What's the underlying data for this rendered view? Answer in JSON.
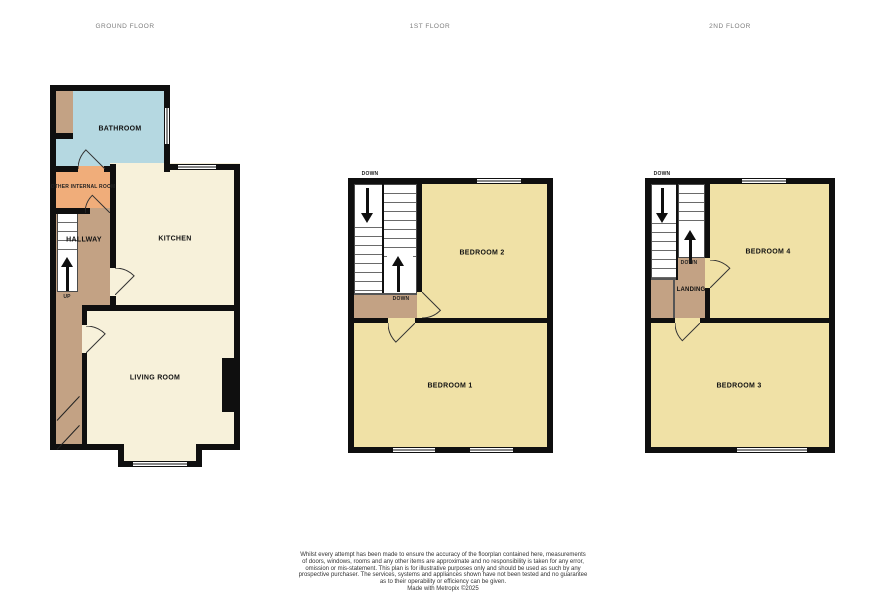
{
  "floors": [
    {
      "title": "GROUND FLOOR",
      "rooms": {
        "bathroom": "BATHROOM",
        "other_internal": "OTHER INTERNAL ROOM",
        "hallway": "HALLWAY",
        "kitchen": "KITCHEN",
        "living_room": "LIVING ROOM"
      },
      "stair_labels": {
        "up": "UP"
      }
    },
    {
      "title": "1ST FLOOR",
      "rooms": {
        "bedroom2": "BEDROOM 2",
        "bedroom1": "BEDROOM 1"
      },
      "stair_labels": {
        "down_exterior": "DOWN",
        "down_landing": "DOWN"
      }
    },
    {
      "title": "2ND FLOOR",
      "rooms": {
        "bedroom4": "BEDROOM 4",
        "bedroom3": "BEDROOM 3",
        "landing": "LANDING"
      },
      "stair_labels": {
        "down_exterior": "DOWN",
        "down_landing": "DOWN"
      }
    }
  ],
  "footer": {
    "disclaimer_lines": [
      "Whilst every attempt has been made to ensure the accuracy of the floorplan contained here, measurements",
      "of doors, windows, rooms and any other items are approximate and no responsibility is taken for any error,",
      "omission or mis-statement. This plan is for illustrative purposes only and should be used as such by any",
      "prospective purchaser. The services, systems and appliances shown have not been tested and no guarantee",
      "as to their operability or efficiency can be given."
    ],
    "credit": "Made with Metropix ©2025"
  },
  "colors": {
    "wall": "#0f0f0f",
    "bathroom": "#b5d8e1",
    "internal_room": "#f0ad7a",
    "hallway": "#c3a284",
    "kitchen_living": "#f7f1da",
    "bedroom": "#f0e1a6",
    "stairs": "#ffffff"
  }
}
